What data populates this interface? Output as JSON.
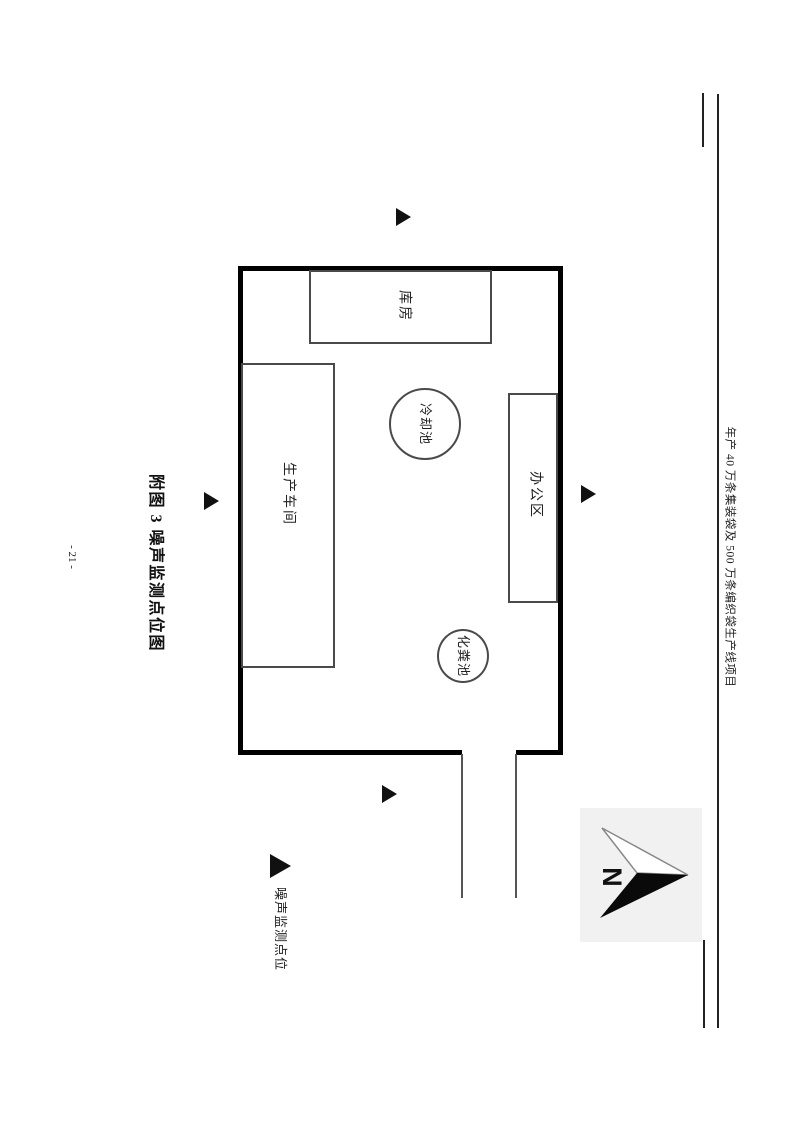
{
  "header": {
    "project_title": "年产 40 万条集装袋及 500 万条编织袋生产线项目"
  },
  "figure": {
    "title": "附图 3 噪声监测点位图",
    "rooms": {
      "warehouse": "库房",
      "workshop": "生产车间",
      "office": "办公区"
    },
    "pools": {
      "cooling": "冷却池",
      "septic": "化粪池"
    },
    "compass_label": "N",
    "monitoring_points": [
      "north",
      "west",
      "east",
      "south"
    ]
  },
  "legend": {
    "label": "噪声监测点位"
  },
  "footer": {
    "page_number": "- 21 -"
  },
  "colors": {
    "wall": "#000000",
    "thin_line": "#4a4a4a",
    "marker": "#111111",
    "compass_background": "#f1f1f1"
  }
}
